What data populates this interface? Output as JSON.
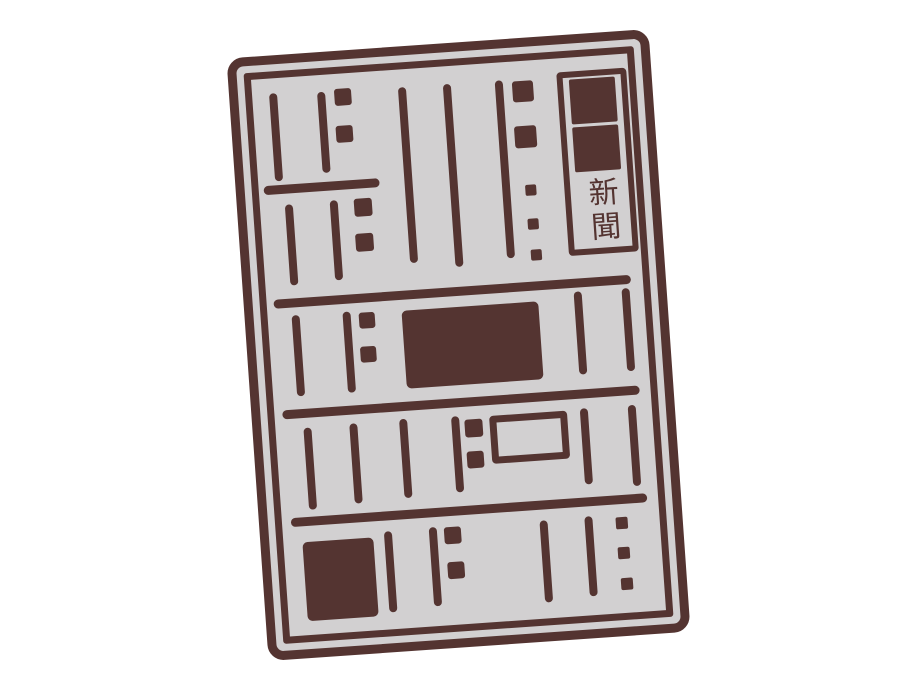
{
  "illustration": {
    "masthead_text": "新聞",
    "colors": {
      "ink": "#543431",
      "paper": "#d2d0d1",
      "background": "#ffffff"
    }
  }
}
